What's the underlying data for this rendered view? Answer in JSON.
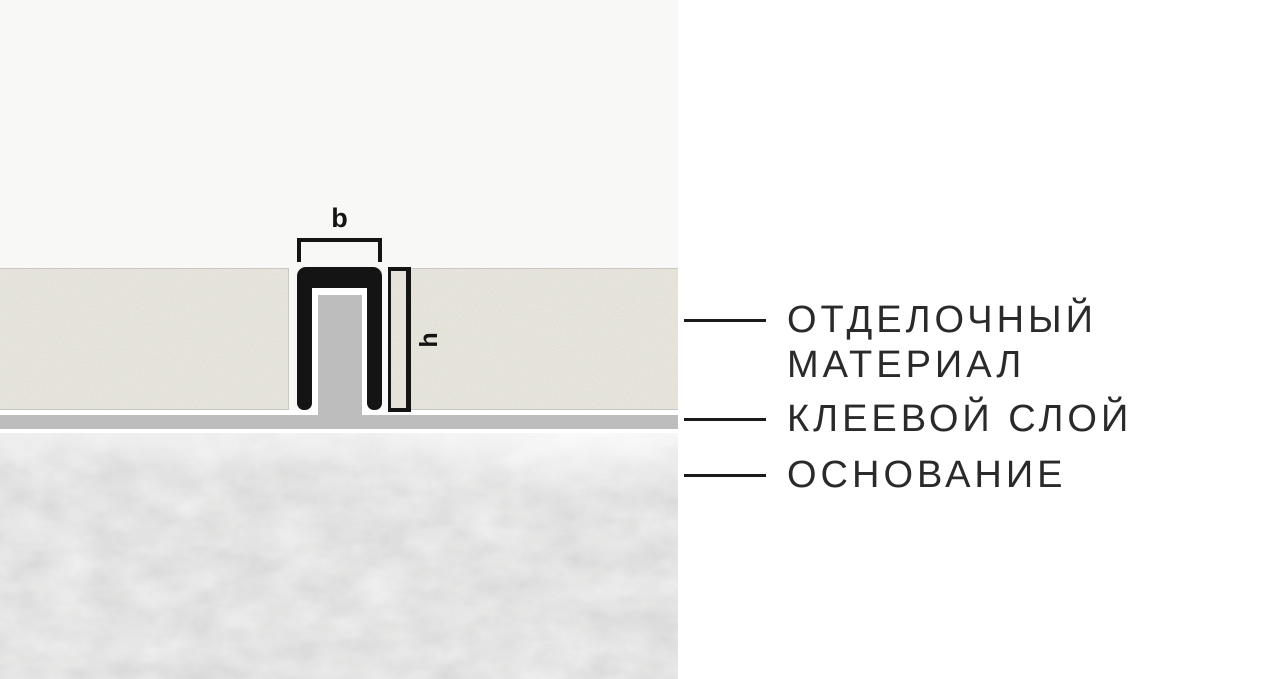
{
  "diagram": {
    "dimensions": {
      "width_label": "b",
      "height_label": "h"
    },
    "layers": {
      "finishing_material_line1": "ОТДЕЛОЧНЫЙ",
      "finishing_material_line2": "МАТЕРИАЛ",
      "adhesive_layer": "КЛЕЕВОЙ СЛОЙ",
      "base": "ОСНОВАНИЕ"
    },
    "colors": {
      "profile_black": "#141414",
      "finishing_material_beige": "#ebe9df",
      "adhesive_gray": "#bdbdbd",
      "base_concrete_gray": "#dcdcdb",
      "panel_background": "#f8f8f7",
      "page_background": "#ffffff",
      "text": "#2a2a2a"
    }
  }
}
